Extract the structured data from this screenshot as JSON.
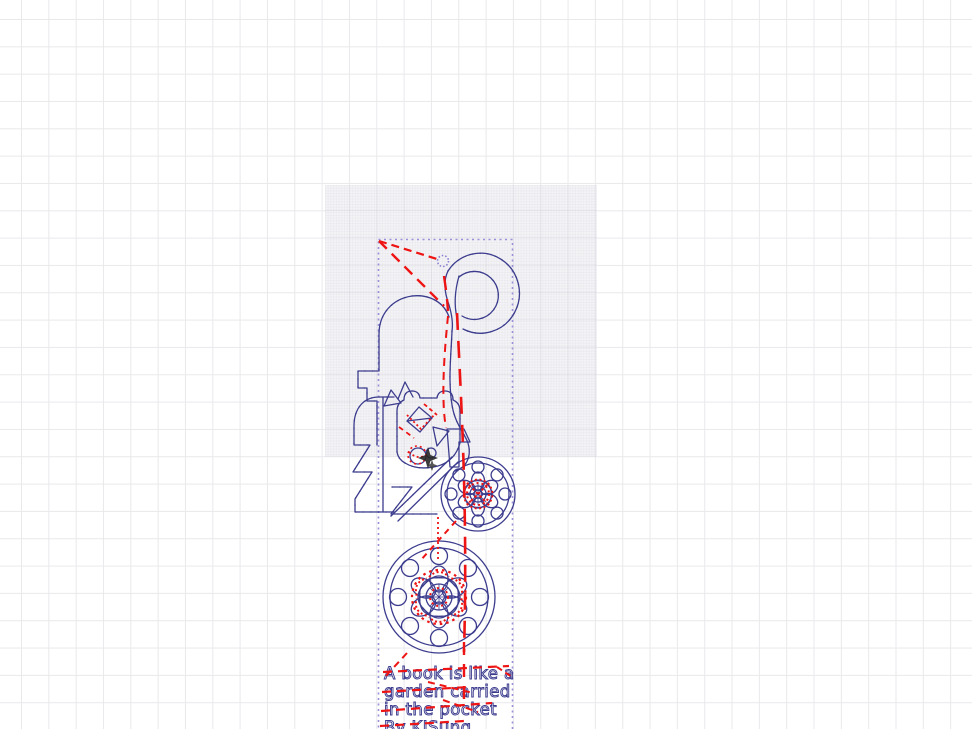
{
  "canvas": {
    "background_color": "#ffffff",
    "grid_color": "#e9e9ec",
    "grid_spacing_px": 27.33,
    "material_area_fill": "#f3f3f6"
  },
  "palette": {
    "design_stroke": "#3c3c8e",
    "node_dot": "#7d7dd8",
    "travel_line": "#ee1414",
    "selection_marquee": "#9b8fd9",
    "position_marker": "#262626"
  },
  "design": {
    "quote": {
      "lines": [
        "A book is like a",
        "garden carried",
        "in the pocket",
        "By KJSung"
      ]
    }
  }
}
